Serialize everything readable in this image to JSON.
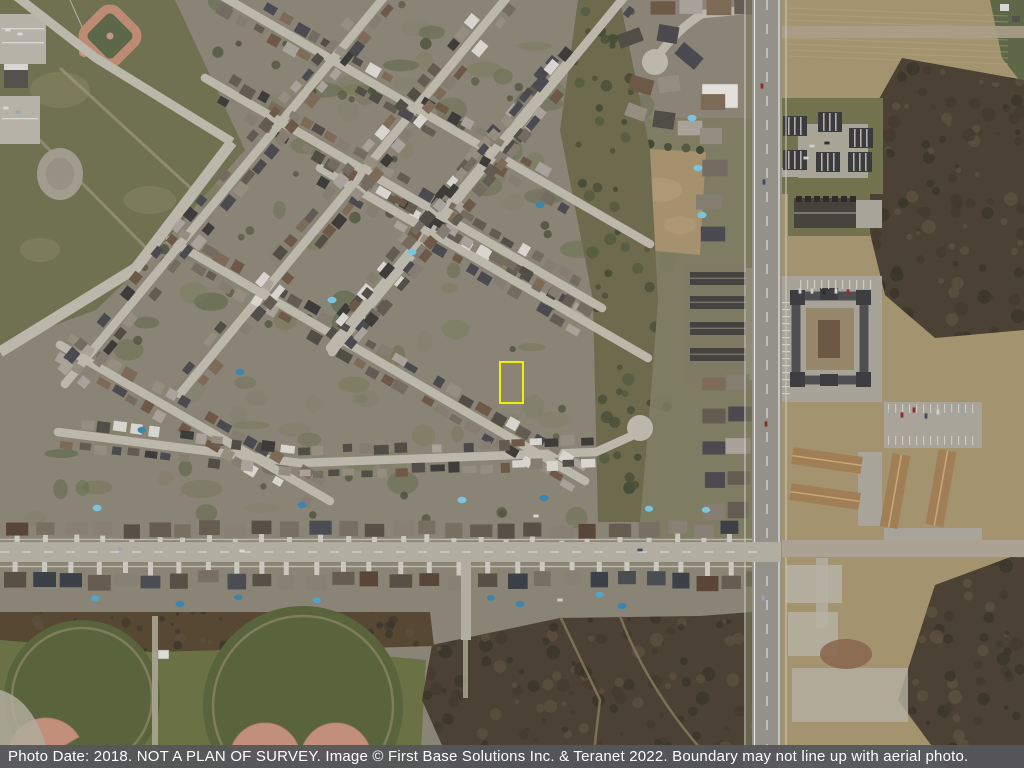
{
  "footer": {
    "text": "Photo Date: 2018. NOT A PLAN OF SURVEY. Image © First Base Solutions Inc. & Teranet 2022. Boundary may not line up with aerial photo.",
    "background": "#55565A",
    "text_color": "#FFFFFF"
  },
  "boundary": {
    "x": 499,
    "y": 361,
    "width": 25,
    "height": 43,
    "color": "#EEF200",
    "thickness": 2.5
  },
  "colors": {
    "terrain_west": "#8A8477",
    "terrain_east": "#A4936F",
    "street": "#BBB7AB",
    "concrete": "#D7D4CB",
    "main_road": "#94908A",
    "cross_road": "#B2ADA1",
    "road_marking": "#E8E6DC",
    "park_nw": "#6F7150",
    "park_south": "#6A7245",
    "circle_green": "#59633C",
    "greenbelt": "#6D6A4E",
    "scrub": "#4B4134",
    "ravine": "#564832",
    "infield": "#C28F7A",
    "dark_building": "#3B3B3D",
    "tan_roof": "#A07F57",
    "pool": [
      "#4FA6CA",
      "#3E84AB",
      "#7CC4DE"
    ],
    "lawn": [
      "#6D7254",
      "#777A58",
      "#5E6848",
      "#80806A"
    ],
    "tree": [
      "#4C5038",
      "#434A33",
      "#565A40"
    ],
    "roofs": [
      "#3E3C3B",
      "#514D47",
      "#625C53",
      "#746C61",
      "#857D71",
      "#958D80",
      "#6E5847",
      "#7D6A57",
      "#4A4A50",
      "#A9A29A",
      "#D8D5CF"
    ],
    "road_roofs": [
      "#3C4148",
      "#4A4D52",
      "#565046",
      "#665D50",
      "#776F62",
      "#888075",
      "#5A4638"
    ],
    "scrub_texture": [
      "#3A342A",
      "#5C5040",
      "#433B2E"
    ]
  }
}
